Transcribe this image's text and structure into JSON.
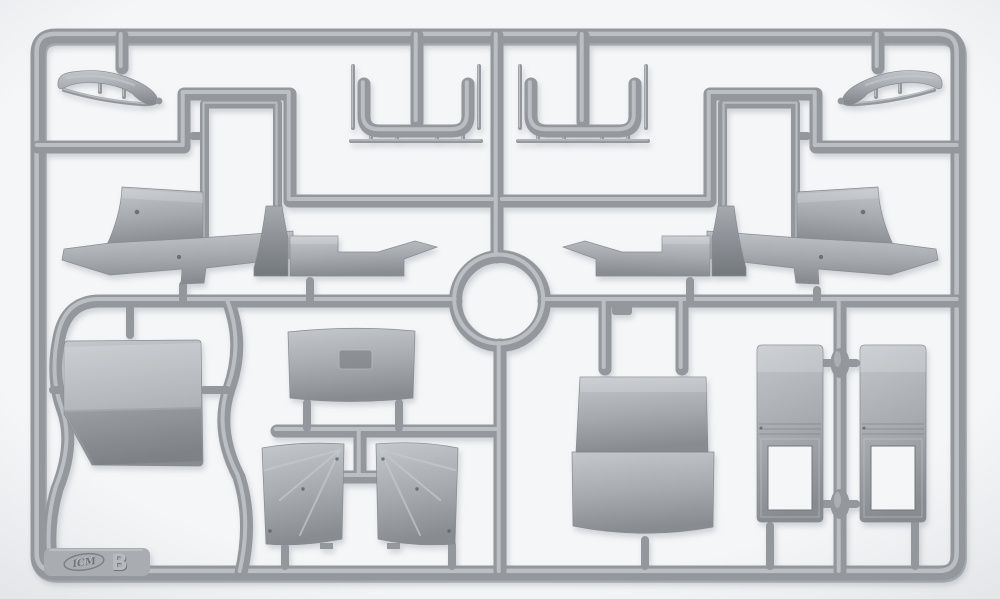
{
  "scene": {
    "kind": "photograph",
    "subject": "gray styrene model-kit sprue (injection molding parts frame) on white background",
    "sprue_letter": "B",
    "brand_logo": "ICM"
  },
  "colors": {
    "bg_center": "#f5f6f8",
    "bg_edge": "#e2e4e7",
    "plastic_base": "#94989d",
    "plastic_mid": "#a6aaaf",
    "plastic_light": "#c4c8cc",
    "plastic_dark": "#73777c",
    "plastic_edge": "#888c91",
    "hole": "#585c61",
    "plate": "#a9adb2",
    "shadow": "#868e96",
    "emboss_dark": "#6f7378",
    "emboss_light": "#c9ccd0"
  },
  "parts": [
    {
      "name": "curved-fender-left"
    },
    {
      "name": "curved-fender-right"
    },
    {
      "name": "u-shaped-frame-left"
    },
    {
      "name": "u-shaped-frame-right"
    },
    {
      "name": "windshield-frame-left"
    },
    {
      "name": "windshield-frame-right"
    },
    {
      "name": "cab-side-panel-group-left"
    },
    {
      "name": "cab-side-panel-group-right"
    },
    {
      "name": "roof-panel"
    },
    {
      "name": "cab-rear-panel-with-window"
    },
    {
      "name": "door-panel-left"
    },
    {
      "name": "door-panel-right"
    },
    {
      "name": "bed-front-panel"
    },
    {
      "name": "framed-window-door-left"
    },
    {
      "name": "framed-window-door-right"
    }
  ]
}
